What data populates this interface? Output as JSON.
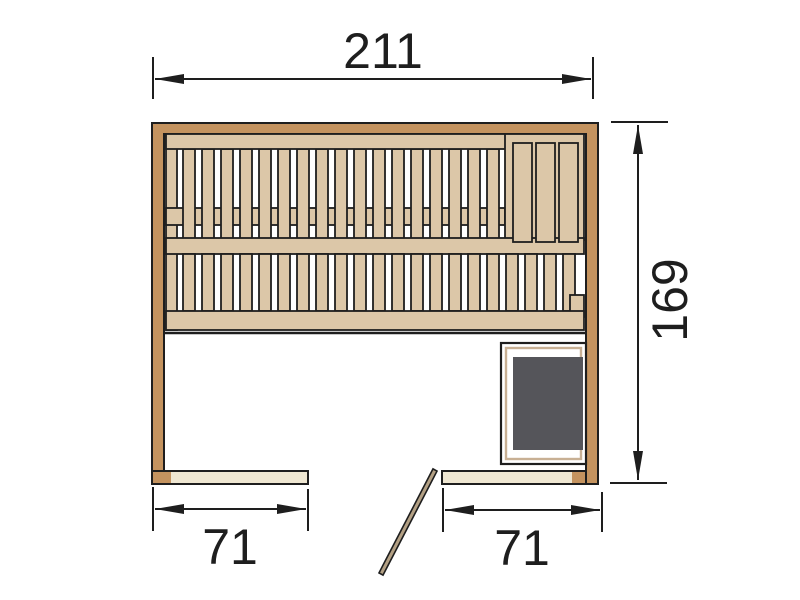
{
  "title": "Sauna floor plan technical drawing",
  "dimensions": {
    "overall_width": "211",
    "overall_depth": "169",
    "opening_left": "71",
    "opening_right": "71"
  },
  "drawing": {
    "colors": {
      "wall": "#c4935f",
      "bench": "#dcc7a8",
      "plate": "#efe7d2",
      "heater": "#55555a",
      "frame": "#c8b094",
      "door": "#b3a084",
      "outline": "#1e1e1e",
      "background": "#ffffff"
    },
    "bench1_slats": {
      "count": 17,
      "x": 183,
      "pitch": 19,
      "y": 149,
      "w": 12,
      "h": 90
    },
    "bench2_slats": {
      "count": 21,
      "x": 183,
      "pitch": 19,
      "y": 254,
      "w": 12,
      "h": 57
    },
    "wide_slats": {
      "xs": [
        513,
        536,
        559
      ],
      "y": 143,
      "w": 19,
      "h": 99
    }
  }
}
